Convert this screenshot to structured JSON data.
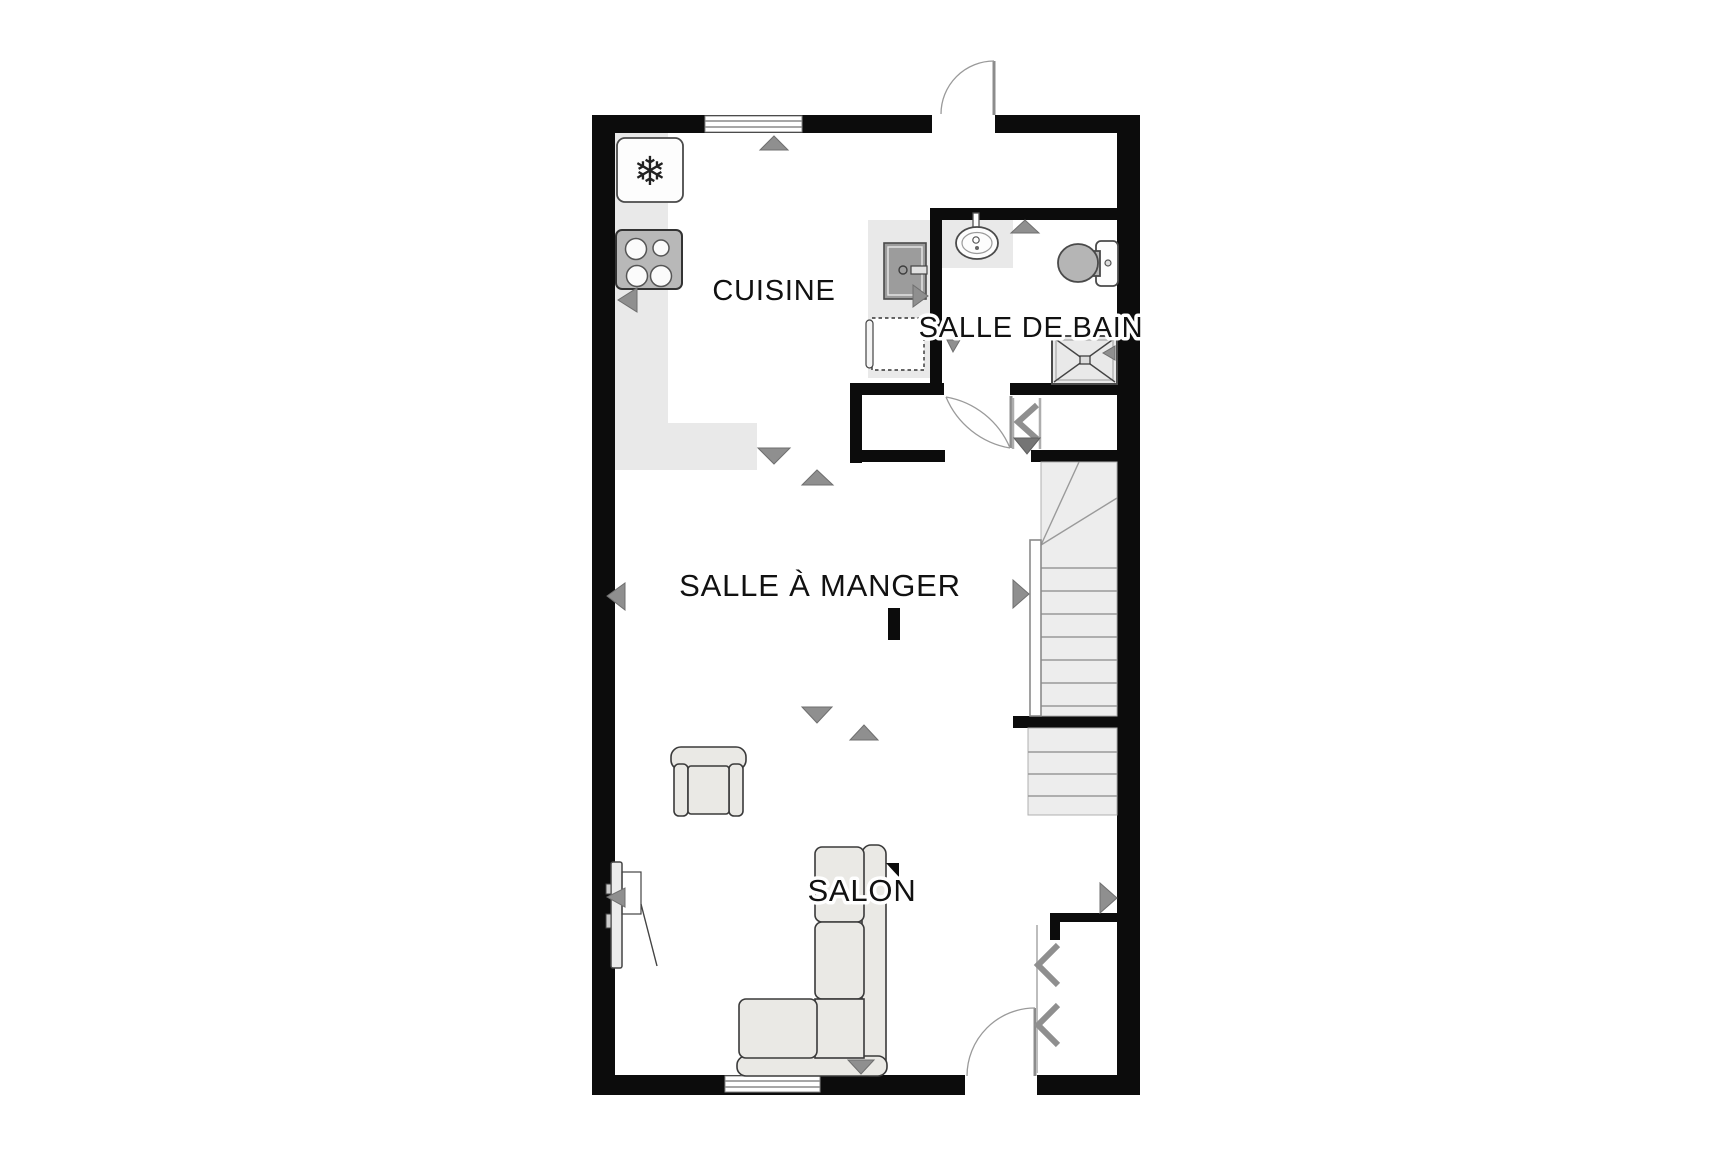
{
  "floor_plan": {
    "kind": "2d-residential-floor-plan",
    "rooms": [
      {
        "id": "cuisine",
        "label": "CUISINE"
      },
      {
        "id": "salle_de_bain",
        "label": "SALLE DE BAIN"
      },
      {
        "id": "salle_a_manger",
        "label": "SALLE À MANGER"
      },
      {
        "id": "salon",
        "label": "SALON"
      }
    ],
    "icons": {
      "fridge_glyph": "❄"
    },
    "fixtures": [
      "fridge-icon",
      "stove-icon",
      "dishwasher-icon",
      "planned-appliance-dashed",
      "sink-icon",
      "toilet-icon",
      "shower-icon",
      "staircase",
      "handrail",
      "sofa",
      "armchair",
      "tv-icon",
      "marker-bar"
    ],
    "doors": [
      "top-entry-door",
      "bottom-entry-door",
      "bathroom-door",
      "hall-folding-door",
      "closet-folding-door"
    ],
    "windows": [
      "top-window",
      "bottom-window"
    ],
    "colors": {
      "wall": "#0c0c0c",
      "floor": "#ffffff",
      "counter": "#e9e9e9",
      "stairs_fill": "#ededed",
      "stairs_line": "#9a9a9a",
      "arrow": "#8f8f8f",
      "arrow_dark": "#757575",
      "appliance": "#9c9c9c",
      "stove": "#b8b8b8",
      "fixture_gray": "#b5b5b5",
      "furniture_fill": "#eae9e5",
      "outline": "#3a3a3a",
      "label": "#111111"
    }
  }
}
